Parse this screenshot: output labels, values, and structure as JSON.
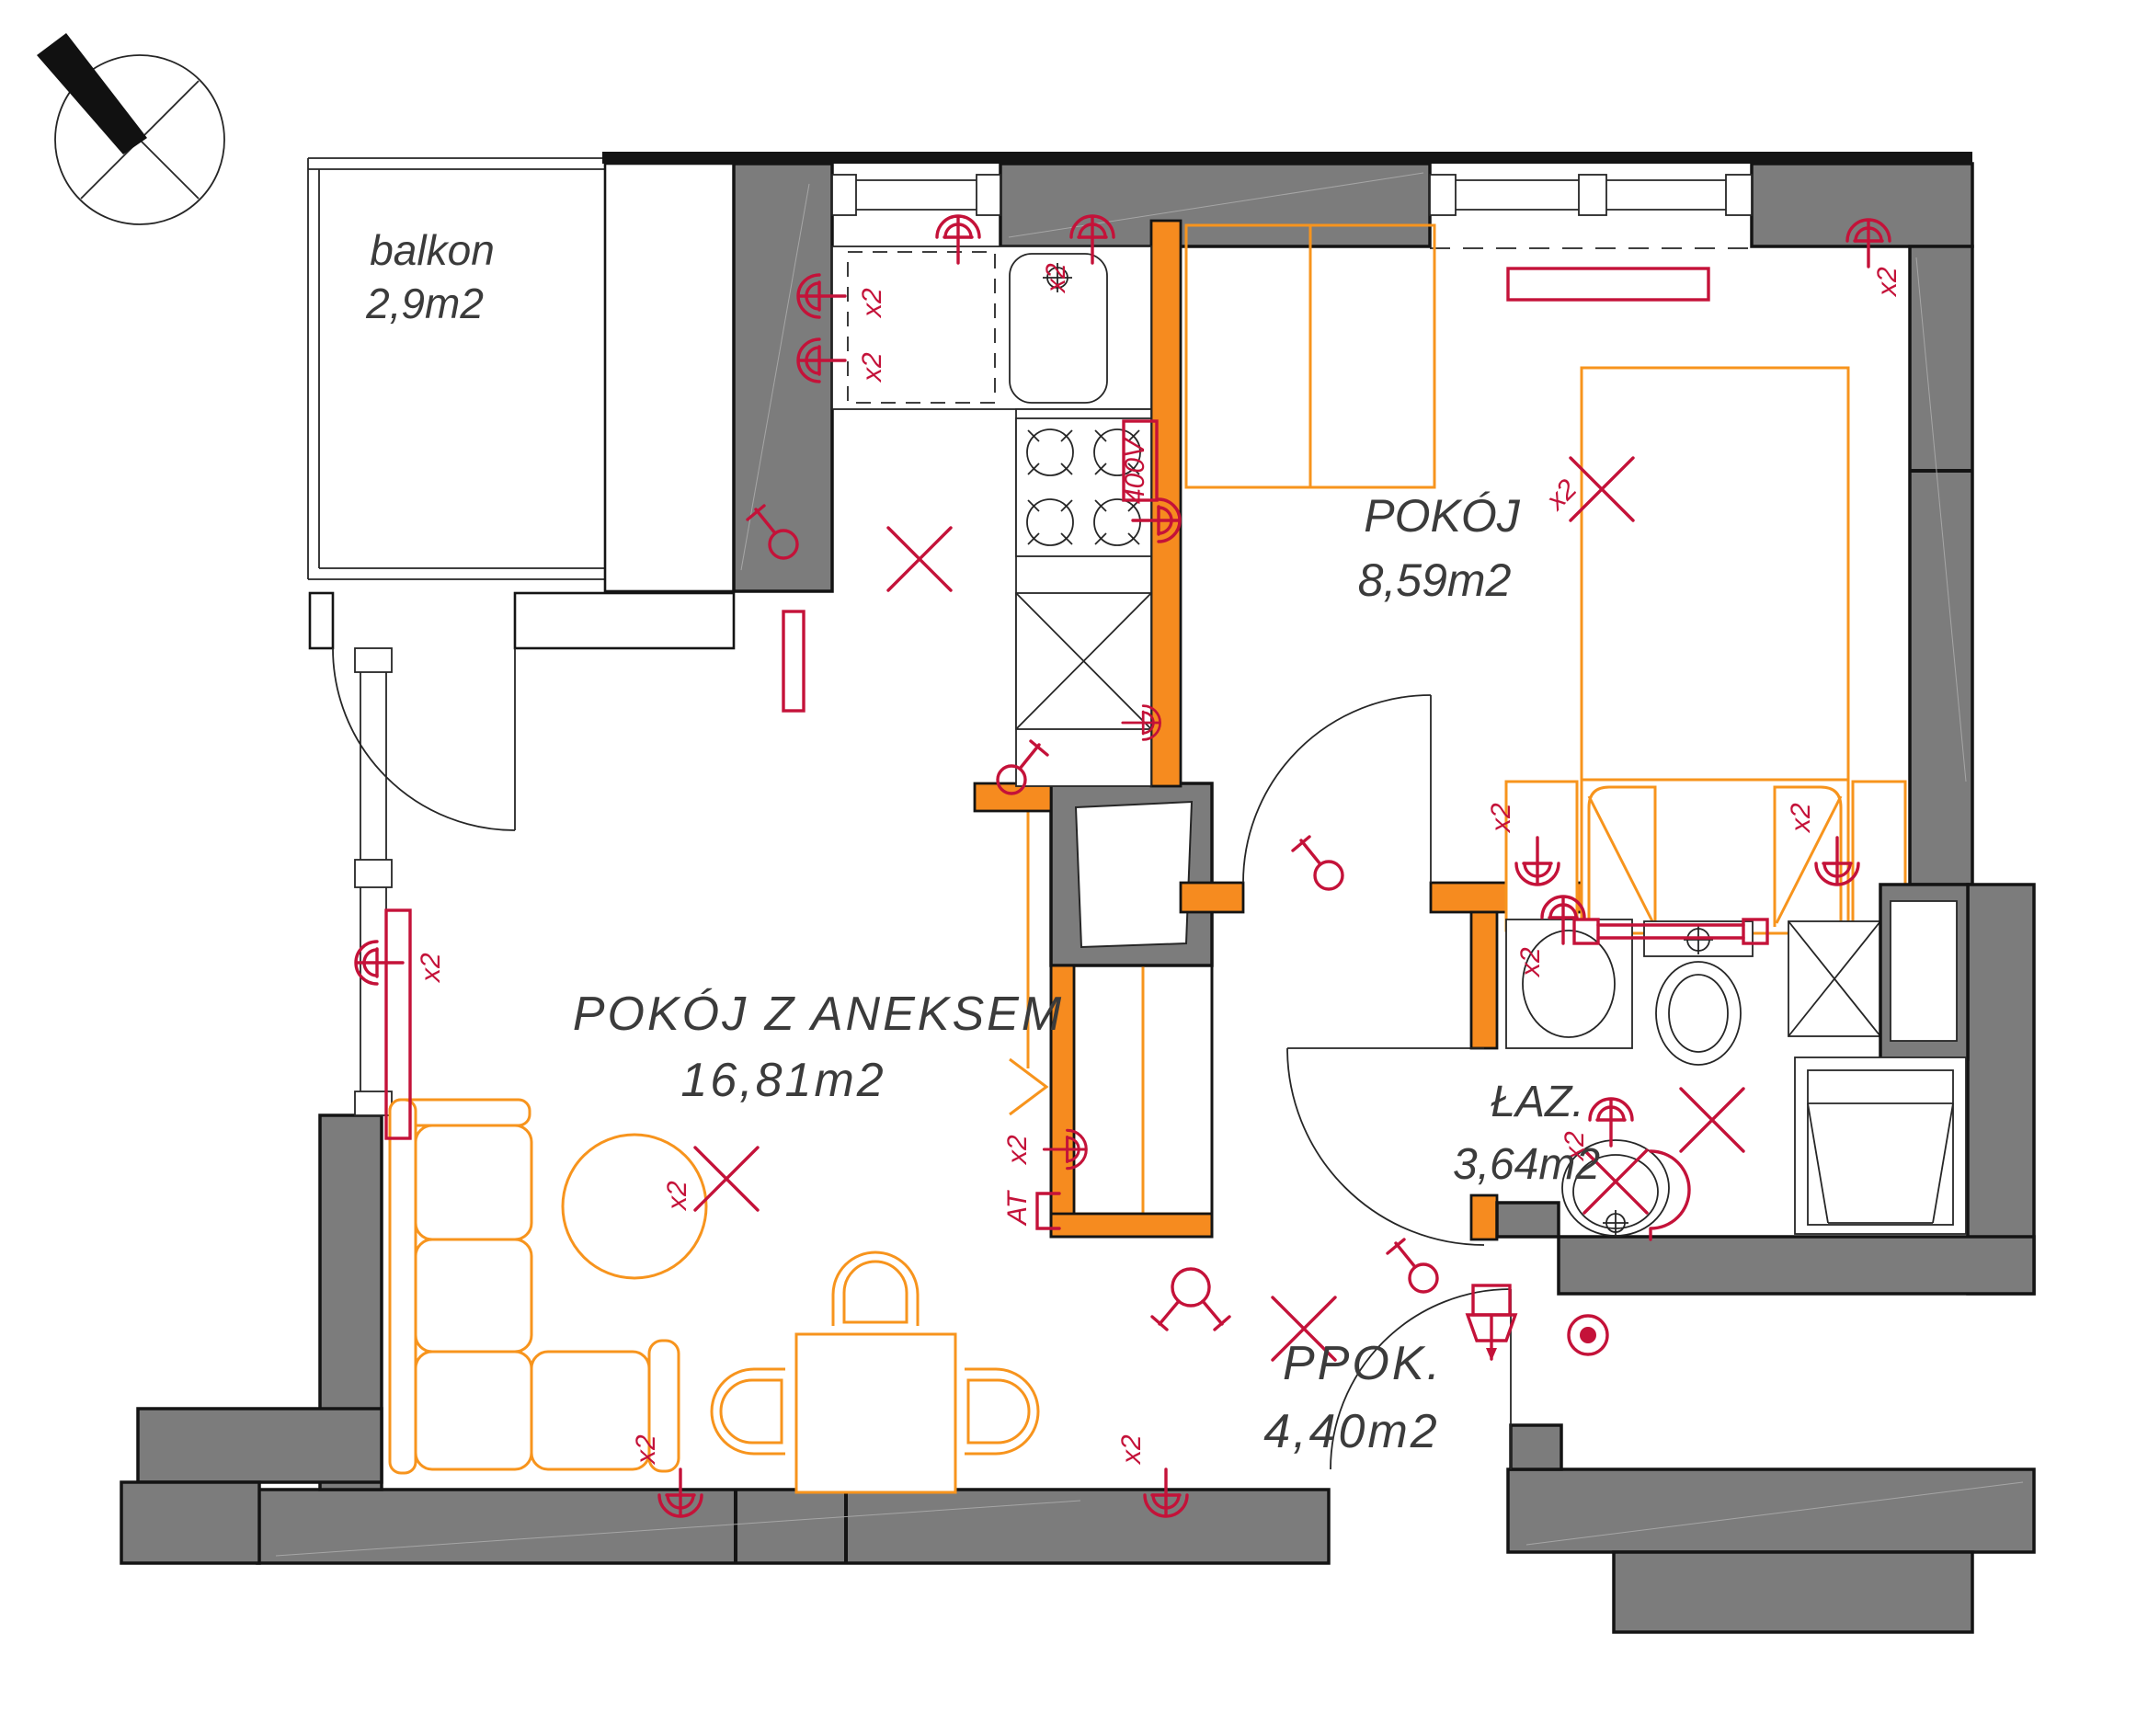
{
  "plan": {
    "rooms": {
      "balcony": {
        "name": "balkon",
        "area": "2,9m2"
      },
      "living": {
        "name": "POKÓJ  Z  ANEKSEM",
        "area": "16,81m2"
      },
      "bedroom": {
        "name": "POKÓJ",
        "area": "8,59m2"
      },
      "bathroom": {
        "name": "ŁAZ.",
        "area": "3,64m2"
      },
      "hall": {
        "name": "PPOK.",
        "area": "4,40m2"
      }
    },
    "labels": {
      "x2": "x2",
      "v400": "400V",
      "at": "AT"
    }
  },
  "colors": {
    "wall": "#7c7c7c",
    "line": "#141414",
    "red": "#c41239",
    "furn": "#f7941d",
    "orange": "#f68b1f",
    "text": "#3b3b3b"
  }
}
